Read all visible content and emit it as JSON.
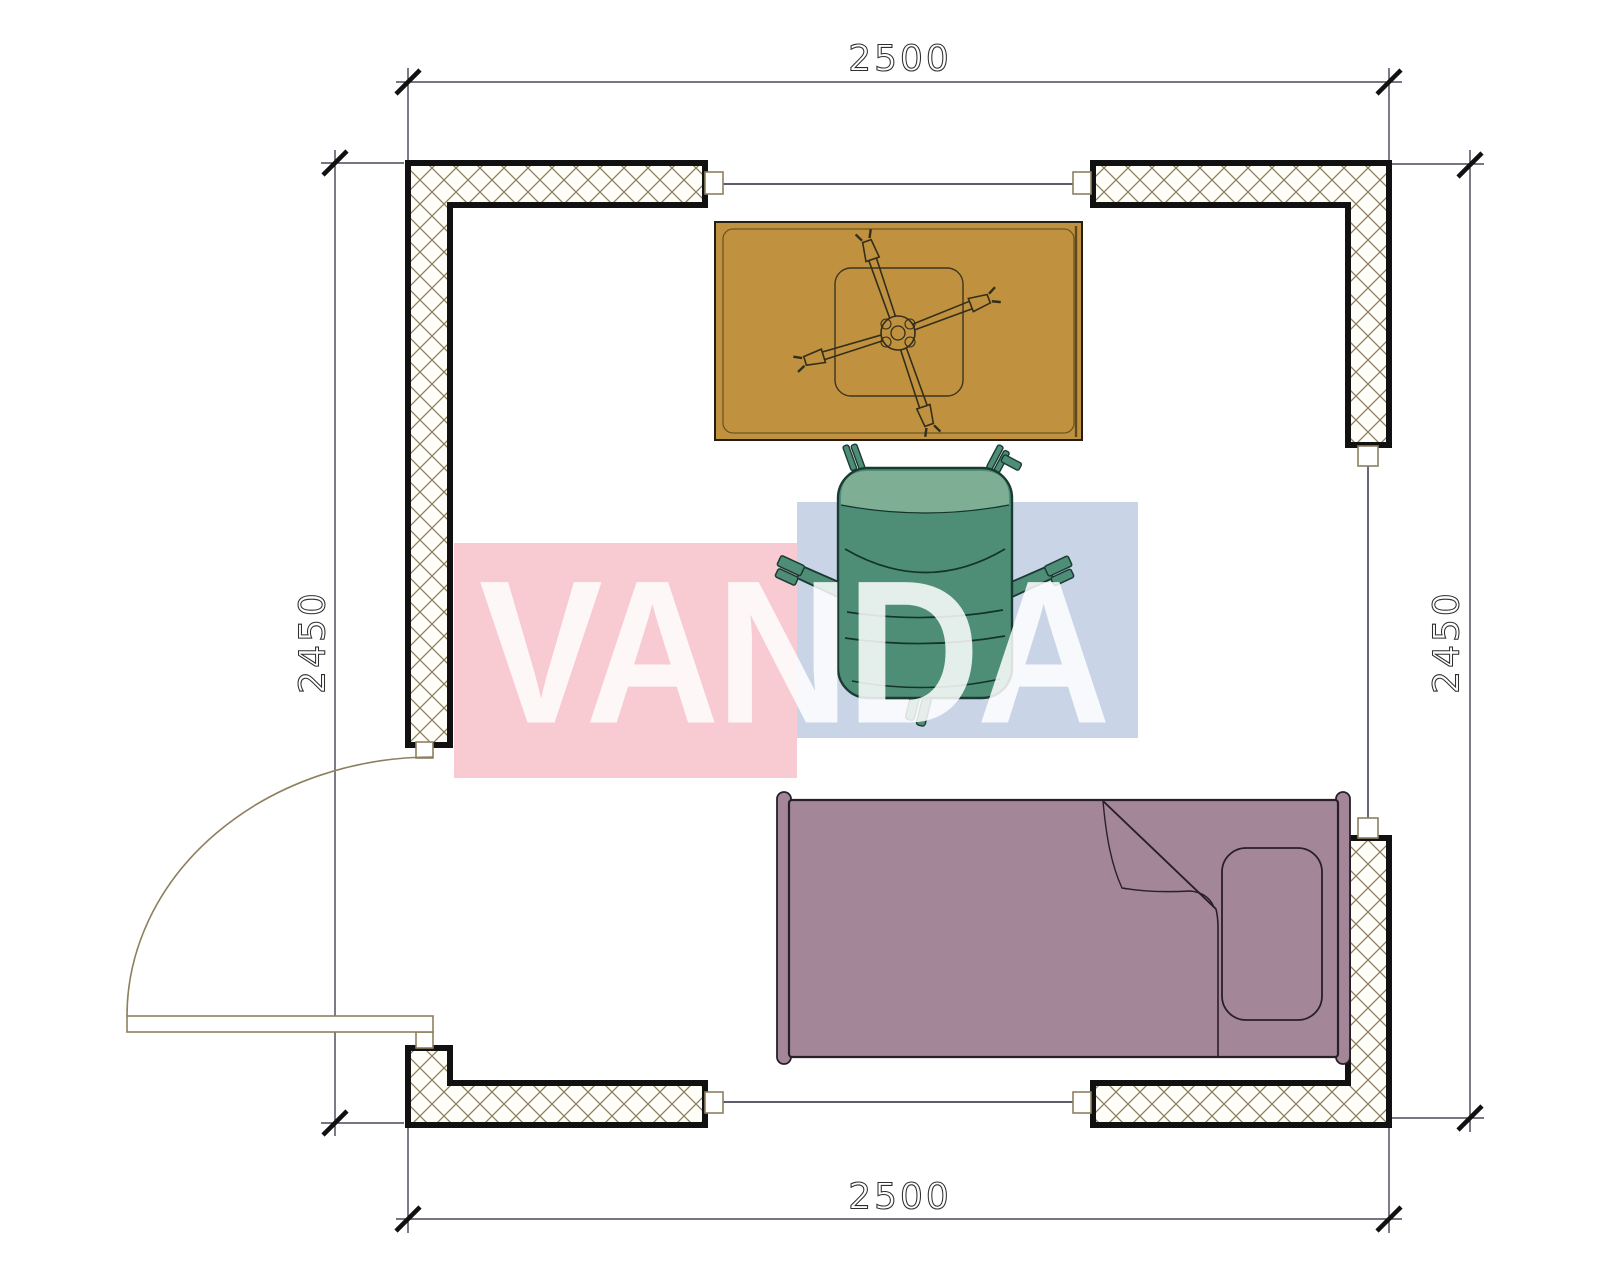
{
  "dimensions": {
    "top": "2500",
    "bottom": "2500",
    "left": "2450",
    "right": "2450"
  },
  "watermark": {
    "text": "VANDA",
    "pink_block": "#F8CAD1",
    "blue_block": "#C9D5E7",
    "text_color": "rgba(255,255,255,0.85)"
  },
  "colors": {
    "wall_outline": "#111111",
    "wall_hatch": "#8d7f5f",
    "hatch_bg": "#fffdf7",
    "dimension_line": "#26263a",
    "tick": "#111111",
    "door": "#8d7f5f",
    "desk_fill": "#C0923F",
    "desk_inner_line": "#6b5526",
    "desk_edge": "#5f4a1e",
    "fan_line": "#332e1a",
    "chair_fill": "#4E8E77",
    "chair_light": "#7EAE93",
    "chair_outline": "#1b3a33",
    "bed_fill": "#A38799",
    "bed_outline": "#2a1f27",
    "jamb_fill": "#ffffff"
  },
  "plan": {
    "type": "room-floor-plan",
    "furniture": [
      "desk",
      "ceiling-fan",
      "office-chair",
      "single-bed",
      "door-swing",
      "pillow",
      "blanket-fold"
    ]
  }
}
